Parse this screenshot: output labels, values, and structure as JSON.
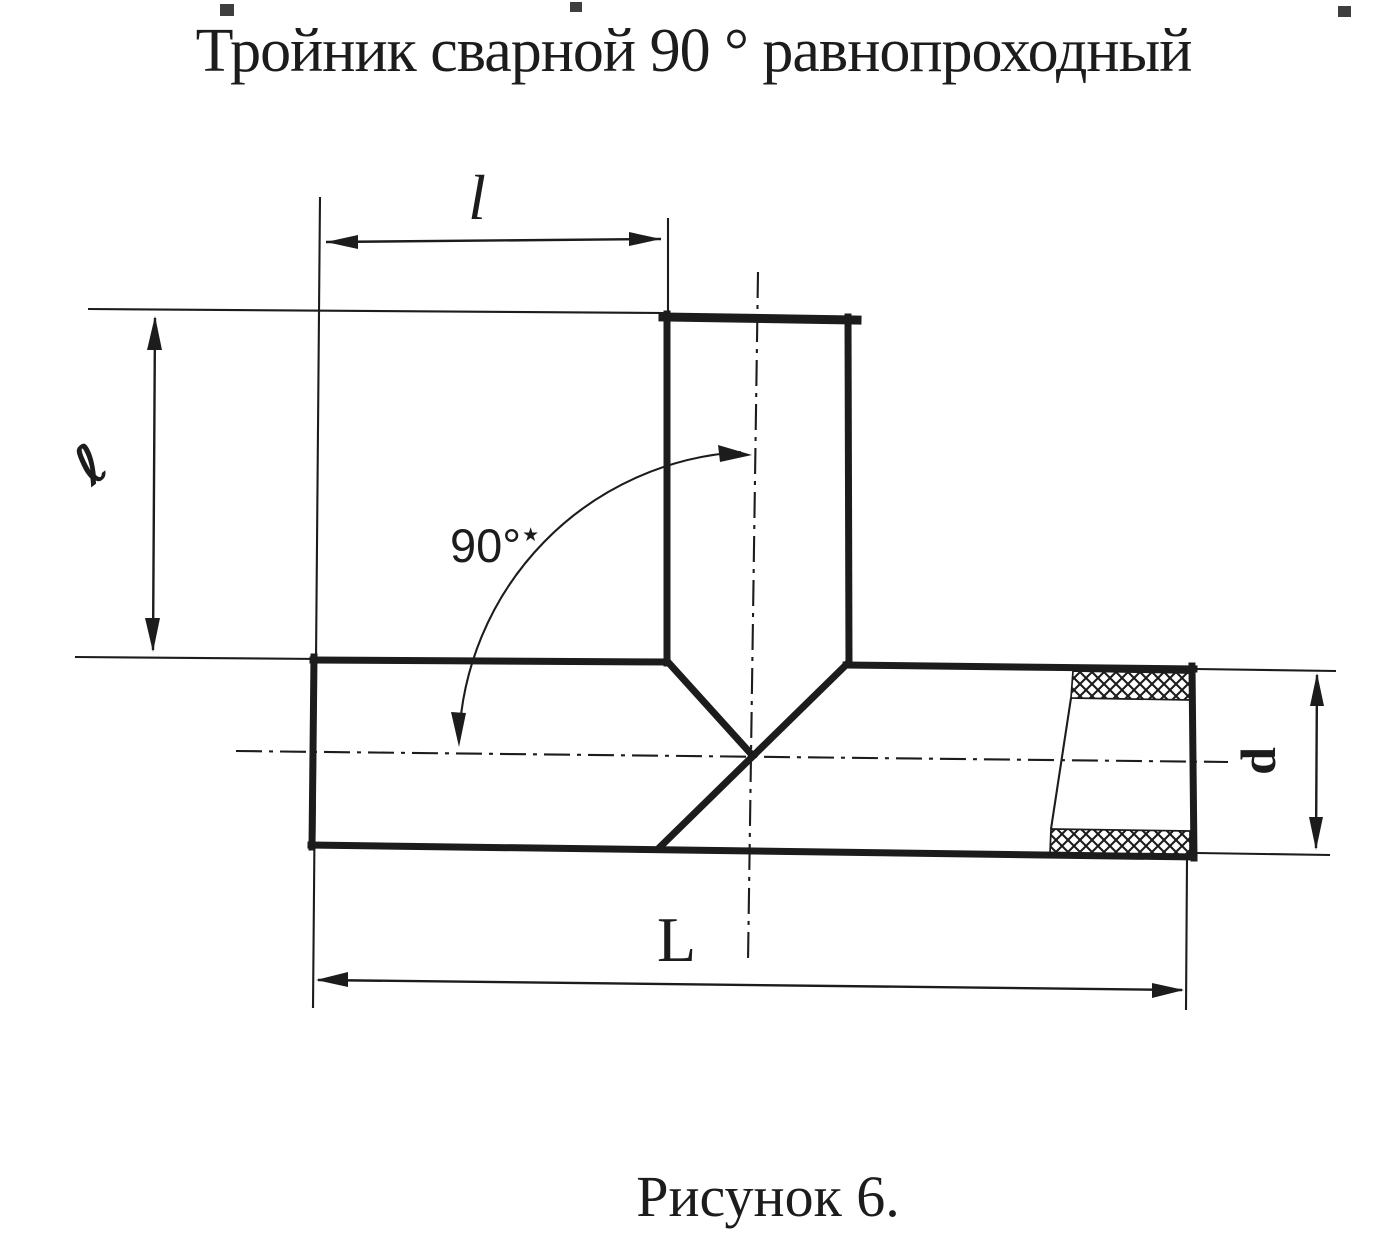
{
  "title": "Тройник сварной 90 ° равнопроходный",
  "caption": "Рисунок 6.",
  "labels": {
    "branch_length_horizontal": "l",
    "branch_length_vertical": "ℓ",
    "angle_value": "90°",
    "angle_marker": "★",
    "overall_length": "L",
    "diameter": "d"
  },
  "colors": {
    "ink": "#1c1c1c",
    "paper": "#ffffff"
  }
}
